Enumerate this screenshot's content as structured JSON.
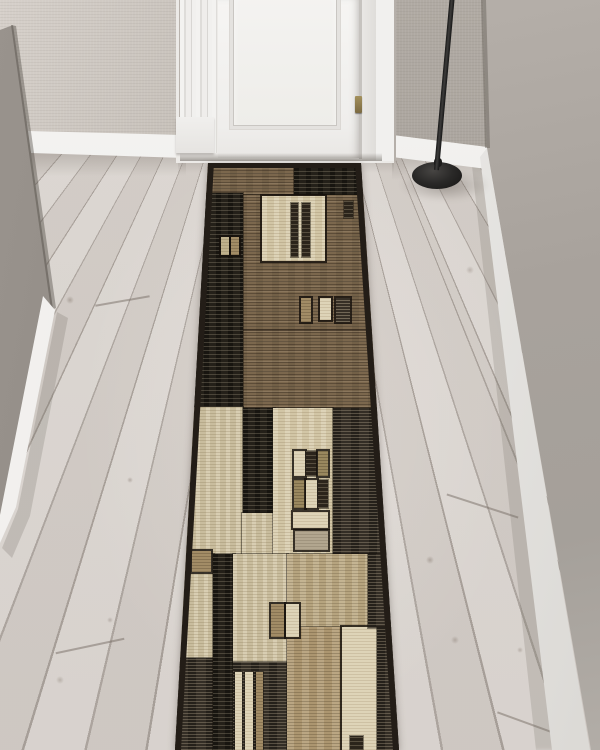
{
  "scene": {
    "setting": "hallway-interior-product-photo",
    "subject": "geometric patchwork runner rug",
    "view": "elevated view toward a closed white door"
  },
  "objects": {
    "door": "white paneled door with fluted casing",
    "hinge": "brass hinge",
    "floor": "whitewashed wood plank floor",
    "lamp": "black floor lamp with round base",
    "left_wall": "greige woven wallpaper",
    "right_wall": "smooth warm-gray wall",
    "baseboard": "white baseboard"
  },
  "palette": {
    "floor": "#d5cfca",
    "plank_seam": "#766c64",
    "wall_left": "#aaa49d",
    "wall_right": "#a8a29c",
    "wall_wedge": "#8e8882",
    "baseboard": "#ecebe9",
    "door": "#f4f3f1",
    "hinge": "#8a7a4f",
    "lamp": "#1f1e1d",
    "rug_black": "#242019",
    "rug_brown": "#7b674d",
    "rug_cream": "#d2c6a6",
    "rug_beige": "#c9bd9e",
    "rug_tan": "#a28c66"
  },
  "rug": {
    "outline": [
      [
        208,
        163
      ],
      [
        361,
        163
      ],
      [
        399,
        750
      ],
      [
        175,
        750
      ]
    ],
    "blocks": [
      {
        "x": 198,
        "y": 162,
        "w": 96,
        "h": 33,
        "tex": "brown"
      },
      {
        "x": 294,
        "y": 162,
        "w": 70,
        "h": 34,
        "tex": "black"
      },
      {
        "x": 240,
        "y": 195,
        "w": 150,
        "h": 213,
        "tex": "brown"
      },
      {
        "x": 243,
        "y": 329,
        "w": 147,
        "h": 2,
        "tex": "seam"
      },
      {
        "x": 192,
        "y": 193,
        "w": 51,
        "h": 214,
        "tex": "black"
      },
      {
        "x": 221,
        "y": 237,
        "w": 8,
        "h": 18,
        "tex": "beige",
        "border": true
      },
      {
        "x": 231,
        "y": 237,
        "w": 8,
        "h": 18,
        "tex": "tan",
        "border": true
      },
      {
        "x": 262,
        "y": 196,
        "w": 63,
        "h": 65,
        "tex": "cream",
        "border": true
      },
      {
        "x": 291,
        "y": 203,
        "w": 7,
        "h": 54,
        "tex": "darkbar"
      },
      {
        "x": 302,
        "y": 203,
        "w": 8,
        "h": 54,
        "tex": "darkbar"
      },
      {
        "x": 344,
        "y": 201,
        "w": 9,
        "h": 17,
        "tex": "darkbar"
      },
      {
        "x": 301,
        "y": 298,
        "w": 10,
        "h": 24,
        "tex": "tan",
        "border": true
      },
      {
        "x": 320,
        "y": 298,
        "w": 11,
        "h": 22,
        "tex": "creambright",
        "border": true
      },
      {
        "x": 336,
        "y": 298,
        "w": 14,
        "h": 24,
        "tex": "darkstripes",
        "border": true
      },
      {
        "x": 186,
        "y": 407,
        "w": 57,
        "h": 148,
        "tex": "beigelt"
      },
      {
        "x": 243,
        "y": 408,
        "w": 32,
        "h": 106,
        "tex": "black"
      },
      {
        "x": 242,
        "y": 513,
        "w": 33,
        "h": 42,
        "tex": "beigelt"
      },
      {
        "x": 273,
        "y": 408,
        "w": 60,
        "h": 146,
        "tex": "cream"
      },
      {
        "x": 294,
        "y": 451,
        "w": 11,
        "h": 25,
        "tex": "creambright",
        "border": true
      },
      {
        "x": 306,
        "y": 451,
        "w": 11,
        "h": 25,
        "tex": "darkbar"
      },
      {
        "x": 318,
        "y": 451,
        "w": 10,
        "h": 25,
        "tex": "tanmottle",
        "border": true
      },
      {
        "x": 294,
        "y": 480,
        "w": 11,
        "h": 28,
        "tex": "tanmottle",
        "border": true
      },
      {
        "x": 306,
        "y": 480,
        "w": 11,
        "h": 28,
        "tex": "creambright",
        "border": true
      },
      {
        "x": 318,
        "y": 480,
        "w": 10,
        "h": 28,
        "tex": "darkbar"
      },
      {
        "x": 293,
        "y": 512,
        "w": 35,
        "h": 16,
        "tex": "creambright",
        "border": true
      },
      {
        "x": 295,
        "y": 531,
        "w": 33,
        "h": 19,
        "tex": "graytan",
        "border": true
      },
      {
        "x": 333,
        "y": 408,
        "w": 62,
        "h": 147,
        "tex": "blackstreak"
      },
      {
        "x": 174,
        "y": 554,
        "w": 40,
        "h": 108,
        "tex": "beigelt"
      },
      {
        "x": 192,
        "y": 551,
        "w": 19,
        "h": 21,
        "tex": "tan",
        "border": true
      },
      {
        "x": 170,
        "y": 658,
        "w": 48,
        "h": 92,
        "tex": "blackstreak"
      },
      {
        "x": 213,
        "y": 554,
        "w": 22,
        "h": 196,
        "tex": "black"
      },
      {
        "x": 233,
        "y": 554,
        "w": 55,
        "h": 110,
        "tex": "beigelt"
      },
      {
        "x": 233,
        "y": 662,
        "w": 57,
        "h": 88,
        "tex": "blackstreak"
      },
      {
        "x": 235,
        "y": 672,
        "w": 7,
        "h": 78,
        "tex": "creambright"
      },
      {
        "x": 245,
        "y": 672,
        "w": 8,
        "h": 78,
        "tex": "creambright"
      },
      {
        "x": 256,
        "y": 672,
        "w": 7,
        "h": 78,
        "tex": "tan"
      },
      {
        "x": 287,
        "y": 554,
        "w": 82,
        "h": 74,
        "tex": "tanlt"
      },
      {
        "x": 287,
        "y": 627,
        "w": 56,
        "h": 123,
        "tex": "tanstreak"
      },
      {
        "x": 342,
        "y": 627,
        "w": 36,
        "h": 123,
        "tex": "creambright",
        "border": true
      },
      {
        "x": 368,
        "y": 554,
        "w": 34,
        "h": 74,
        "tex": "blackstreak"
      },
      {
        "x": 377,
        "y": 627,
        "w": 25,
        "h": 123,
        "tex": "blackstreak"
      },
      {
        "x": 271,
        "y": 604,
        "w": 13,
        "h": 33,
        "tex": "tan",
        "border": true
      },
      {
        "x": 286,
        "y": 604,
        "w": 13,
        "h": 33,
        "tex": "creambright",
        "border": true
      },
      {
        "x": 350,
        "y": 736,
        "w": 13,
        "h": 14,
        "tex": "darkbar"
      }
    ]
  }
}
